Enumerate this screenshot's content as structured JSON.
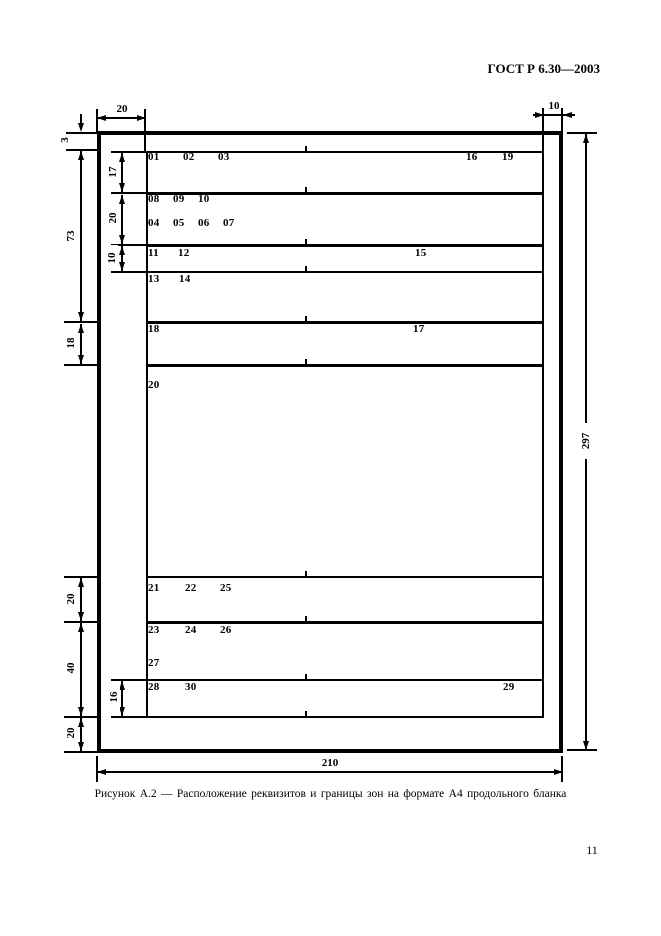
{
  "doc_header": "ГОСТ Р 6.30—2003",
  "caption": "Рисунок А.2 — Расположение реквизитов и границы зон на формате А4 продольного бланка",
  "page_number": "11",
  "fields": {
    "f01": "01",
    "f02": "02",
    "f03": "03",
    "f16": "16",
    "f19": "19",
    "f08": "08",
    "f09": "09",
    "f10": "10",
    "f04": "04",
    "f05": "05",
    "f06": "06",
    "f07": "07",
    "f11": "11",
    "f12": "12",
    "f15": "15",
    "f13": "13",
    "f14": "14",
    "f18": "18",
    "f17": "17",
    "f20": "20",
    "f21": "21",
    "f22": "22",
    "f25": "25",
    "f23": "23",
    "f24": "24",
    "f26": "26",
    "f27": "27",
    "f28": "28",
    "f30": "30",
    "f29": "29"
  },
  "dims": {
    "top_left": "20",
    "top_right": "10",
    "v3": "3",
    "v73": "73",
    "v17": "17",
    "v20a": "20",
    "v10a": "10",
    "v18": "18",
    "v20b": "20",
    "v40": "40",
    "v16": "16",
    "v20c": "20",
    "height": "297",
    "width": "210"
  }
}
